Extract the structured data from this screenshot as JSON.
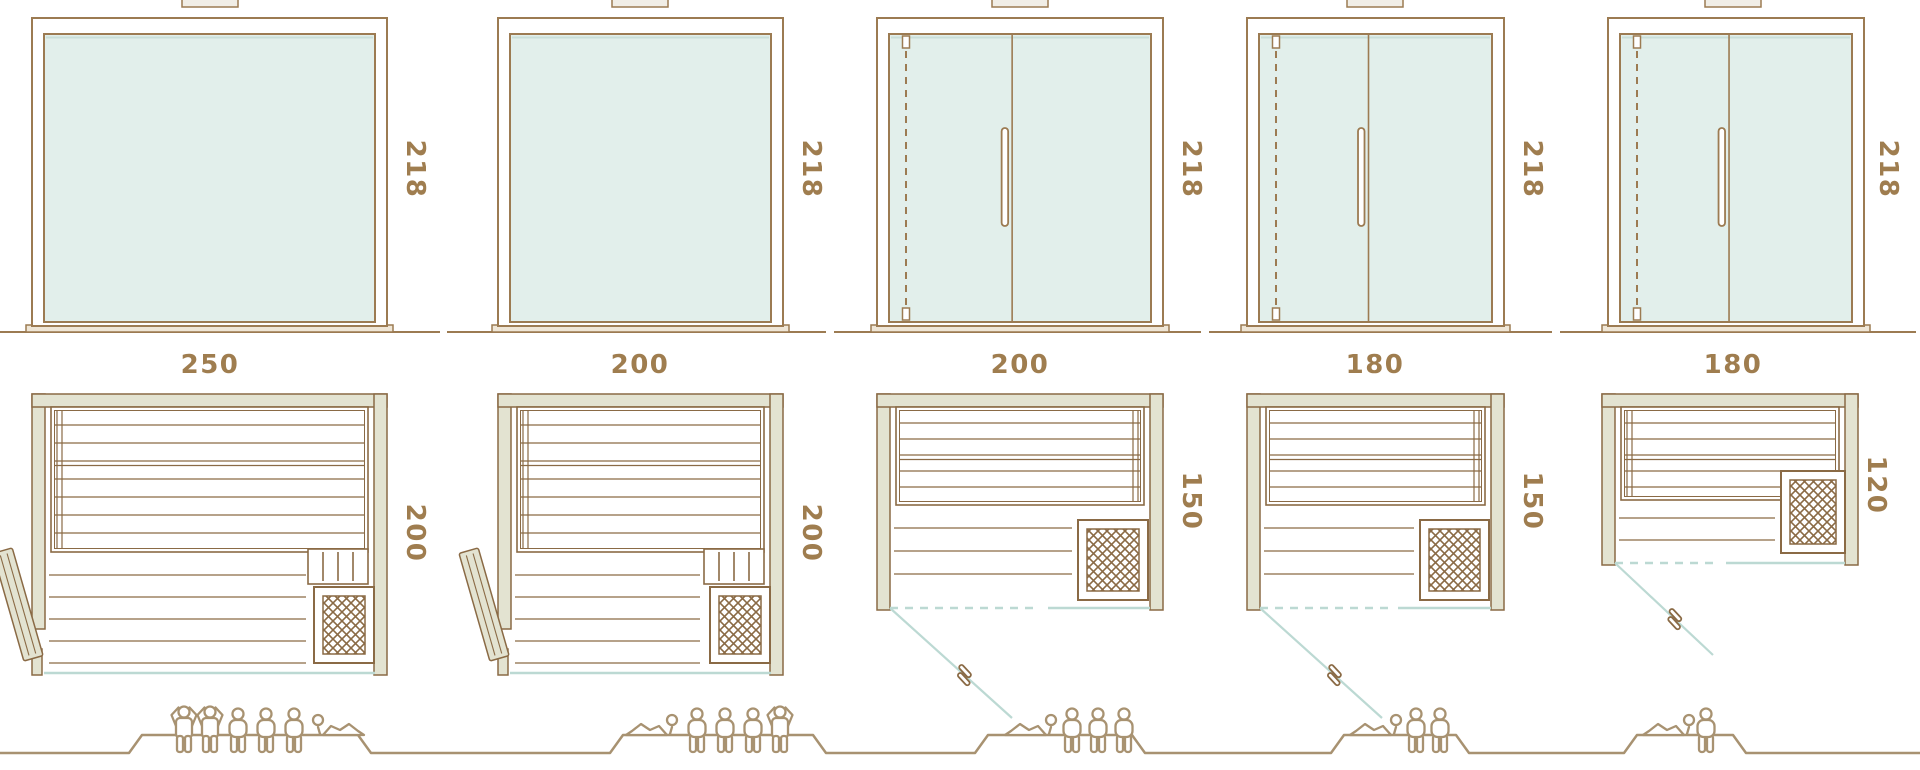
{
  "diagram": {
    "name": "Sauna cabin size lineup — front elevations, floor plans and capacity",
    "rows": [
      "front elevations with height dimension",
      "floor plans with width and depth dimensions",
      "ground line with capacity figures"
    ],
    "columns": [
      {
        "width_label": "250",
        "height_label": "218",
        "depth_label": "200",
        "capacity": 6,
        "front": "fixed glass panel",
        "plan_features": [
          "open wood door leaf at left",
          "two-tier slatted bench",
          "heater with lattice grille bottom-right",
          "guard rail",
          "glass front"
        ],
        "people": [
          "standing",
          "standing",
          "seated",
          "seated",
          "seated",
          "lying"
        ]
      },
      {
        "width_label": "200",
        "height_label": "218",
        "depth_label": "200",
        "capacity": 5,
        "front": "fixed glass panel",
        "plan_features": [
          "open wood door leaf at left",
          "two-tier slatted bench",
          "heater with lattice grille bottom-right",
          "guard rail",
          "glass front"
        ],
        "people": [
          "lying",
          "seated",
          "seated",
          "seated",
          "standing"
        ]
      },
      {
        "width_label": "200",
        "height_label": "218",
        "depth_label": "150",
        "capacity": 4,
        "front": "glass double door with vertical handle, hinge line dashed",
        "plan_features": [
          "glass swing door shown open",
          "slatted bench",
          "heater with lattice grille bottom-right"
        ],
        "people": [
          "lying",
          "seated",
          "seated",
          "seated"
        ]
      },
      {
        "width_label": "180",
        "height_label": "218",
        "depth_label": "150",
        "capacity": 3,
        "front": "glass double door with vertical handle, hinge line dashed",
        "plan_features": [
          "glass swing door shown open",
          "slatted bench",
          "heater with lattice grille bottom-right"
        ],
        "people": [
          "lying",
          "seated",
          "seated"
        ]
      },
      {
        "width_label": "180",
        "height_label": "218",
        "depth_label": "120",
        "capacity": 2,
        "front": "glass single-leaf door with vertical handle, hinge line dashed",
        "plan_features": [
          "glass swing door shown open",
          "slatted bench",
          "heater with lattice grille at right"
        ],
        "people": [
          "lying",
          "seated"
        ]
      }
    ],
    "colors": {
      "line": "#9c7b52",
      "line_dark": "#8a6a45",
      "text": "#9f7d4f",
      "glass": "#e2efeb",
      "wall": "#e3e3d1",
      "blue_line": "#bcd9d3",
      "figure": "#a89271",
      "sill": "#efe6d6",
      "cream": "#f1eee6",
      "white": "#ffffff"
    }
  }
}
